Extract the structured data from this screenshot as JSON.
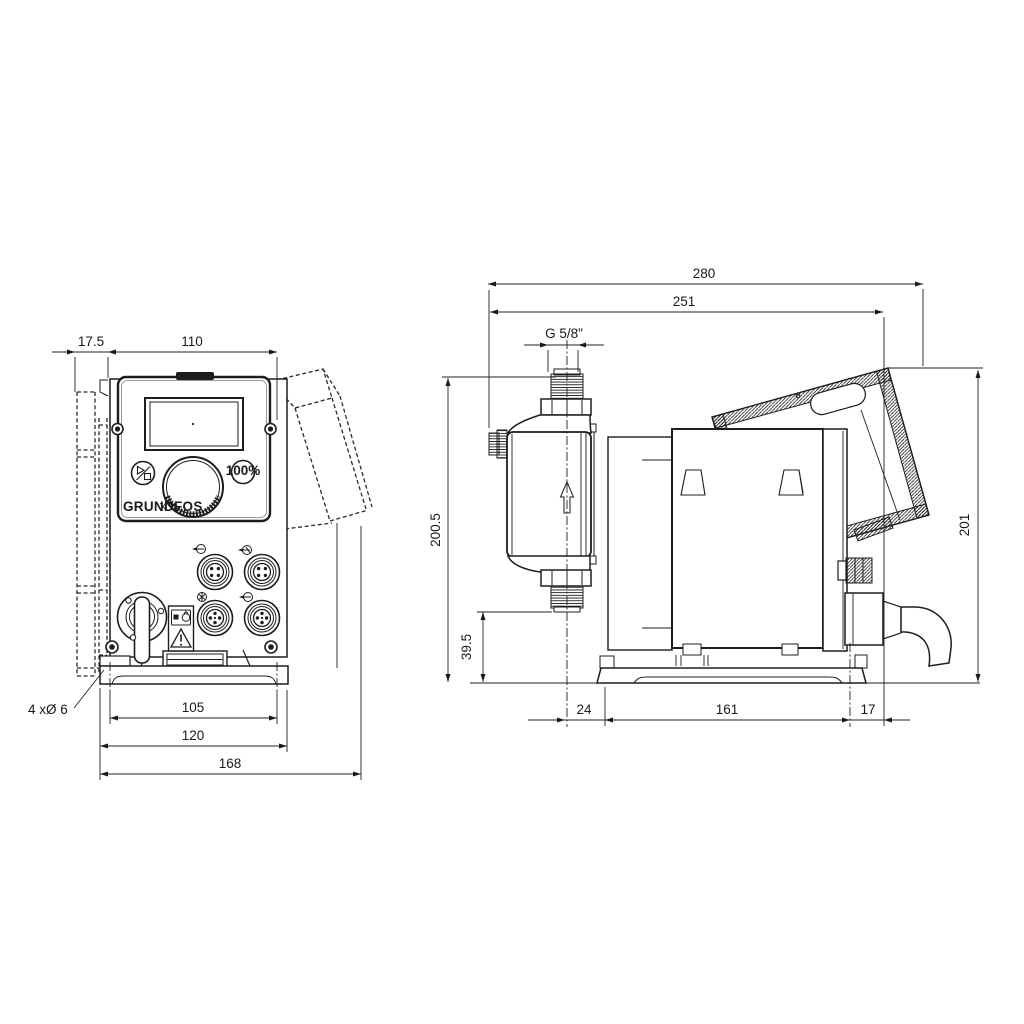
{
  "front": {
    "dims": {
      "offset": "17.5",
      "width": "110",
      "holes_note": "4 xØ 6",
      "hole_spacing": "105",
      "foot_width": "120",
      "overall_width": "168"
    },
    "panel": {
      "logo": "GRUNDFOS",
      "btn_percent": "100%"
    }
  },
  "side": {
    "dims": {
      "overall_depth": "280",
      "depth_to_display": "251",
      "thread": "G 5/8\"",
      "height_overall": "200.5",
      "height_suction": "39.5",
      "height_rear": "201",
      "base_front": "24",
      "base_length": "161",
      "base_rear": "17"
    }
  }
}
